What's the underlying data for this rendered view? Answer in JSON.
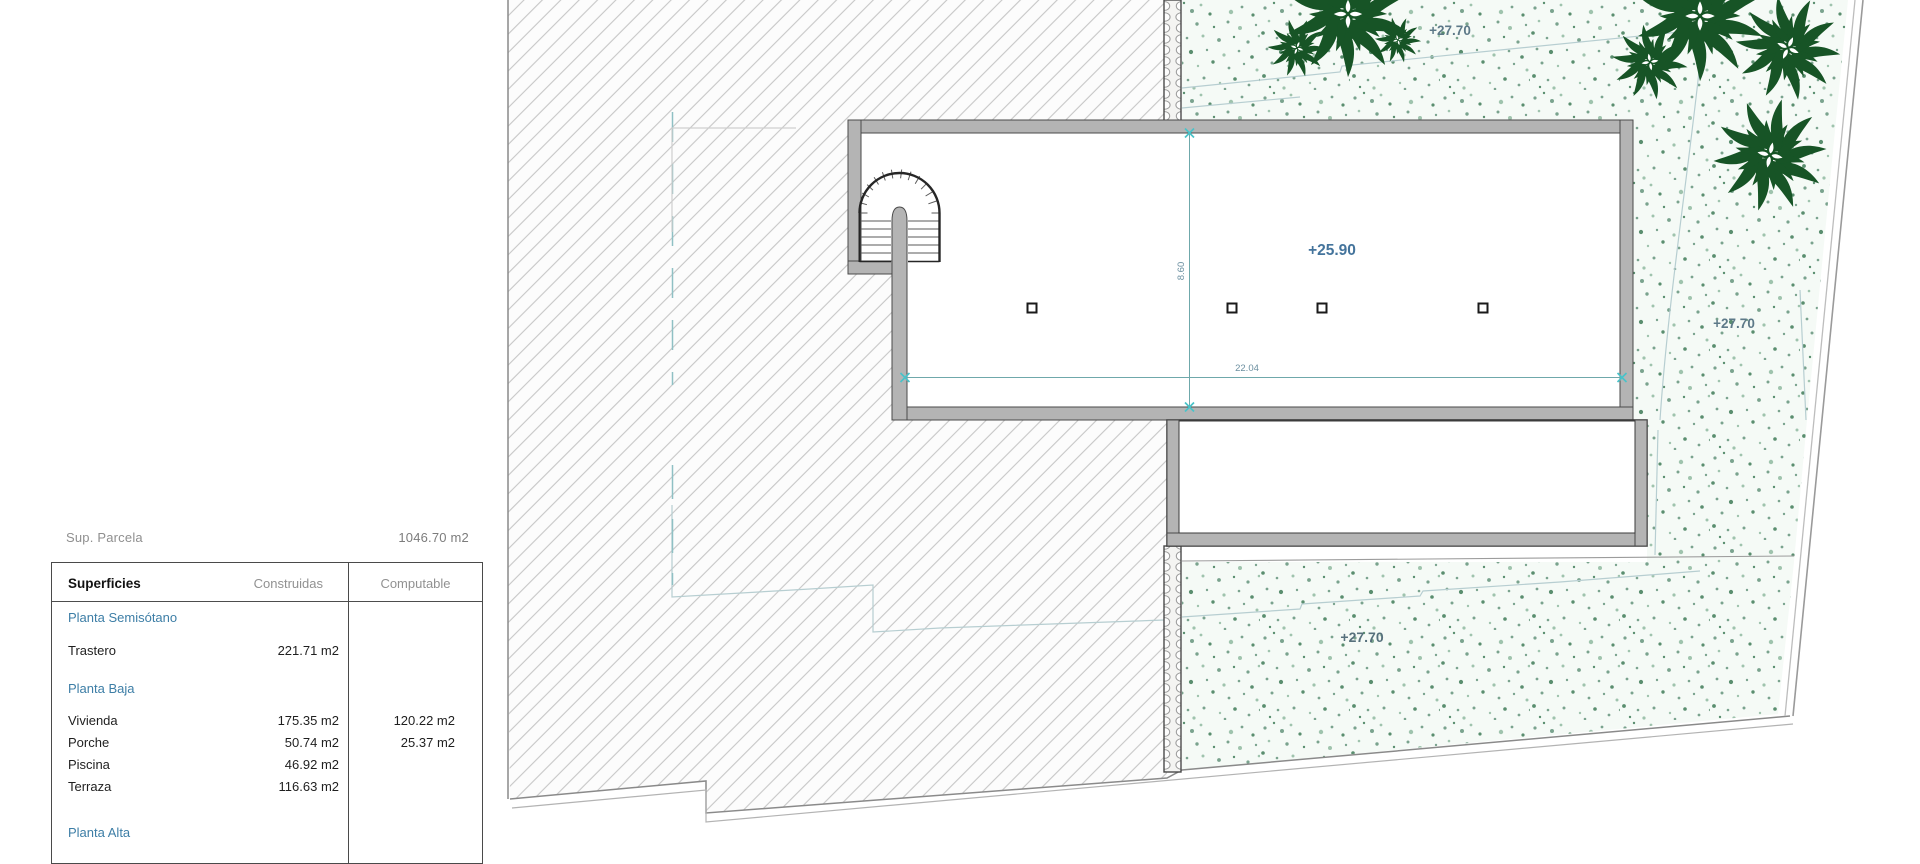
{
  "plan": {
    "levels": {
      "garden_top": "+27.70",
      "building_floor": "+25.90",
      "garden_right": "+27.70",
      "garden_bottom": "+27.70"
    },
    "dimensions": {
      "building_width": "22.04",
      "building_depth": "8.60"
    },
    "symbols": {
      "stair": "spiral-stair",
      "columns": "column-marker",
      "plants": "plant-rosette"
    }
  },
  "summary": {
    "label": "Sup. Parcela",
    "value": "1046.70 m2"
  },
  "table": {
    "headers": [
      "Superficies",
      "Construidas",
      "Computable"
    ],
    "sections": [
      {
        "title": "Planta Semisótano",
        "rows": [
          {
            "label": "Trastero",
            "construida": "221.71 m2",
            "computable": ""
          }
        ]
      },
      {
        "title": "Planta Baja",
        "rows": [
          {
            "label": "Vivienda",
            "construida": "175.35 m2",
            "computable": "120.22 m2"
          },
          {
            "label": "Porche",
            "construida": "50.74 m2",
            "computable": "25.37 m2"
          },
          {
            "label": "Piscina",
            "construida": "46.92 m2",
            "computable": ""
          },
          {
            "label": "Terraza",
            "construida": "116.63 m2",
            "computable": ""
          }
        ]
      },
      {
        "title": "Planta Alta",
        "rows": []
      }
    ]
  },
  "colors": {
    "wall_gray": "#b4b4b4",
    "outline_dark": "#424242",
    "hatch_line": "#c7c7c7",
    "garden_bg": "#f5faf6",
    "stipple_green": "#6f9d84",
    "plant_green": "#175426",
    "dimension_teal": "#6fa8ab",
    "marker_cyan": "#49c3c9",
    "level_label_blue": "#44749c",
    "level_label_gray_blue": "#5d7988",
    "section_title_blue": "#3d7ea6",
    "muted_text_gray": "#8f8f8f"
  }
}
